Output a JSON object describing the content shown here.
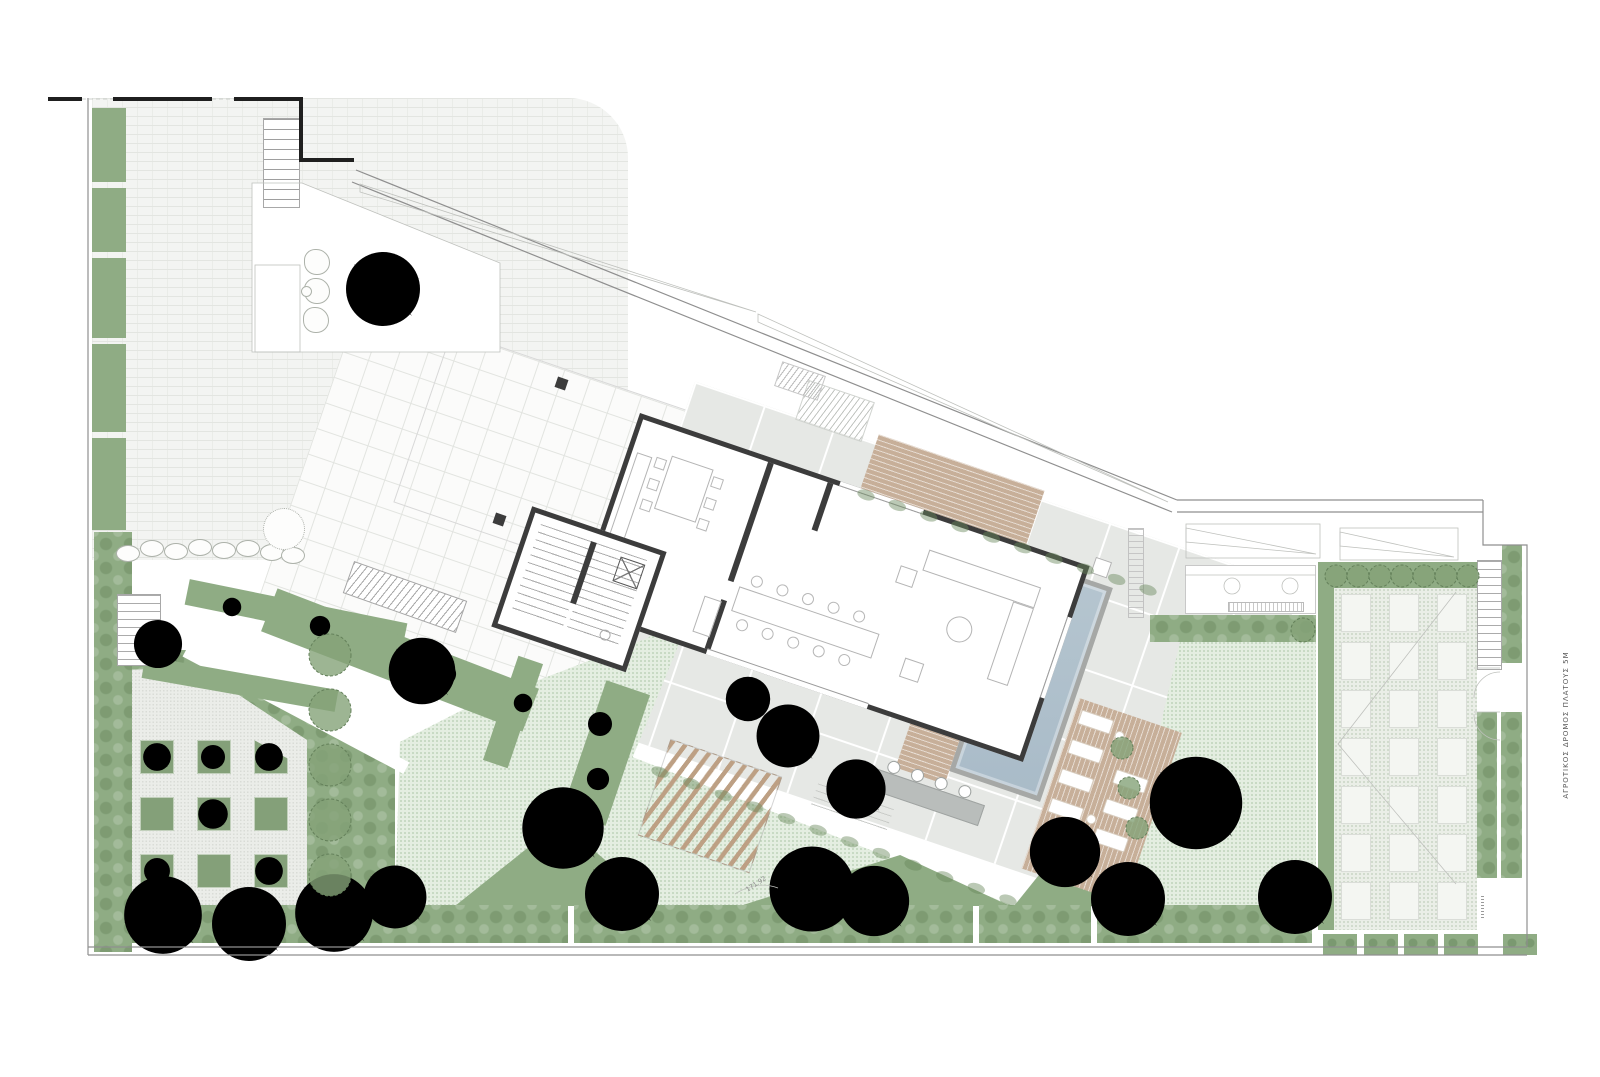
{
  "annotations": {
    "road_label": "ΑΓΡΟΤΙΚΟΣ ΔΡΟΜΟΣ ΠΛΑΤΟΥΣ 5Μ",
    "boundary_dimension": "171.92"
  },
  "palette": {
    "paper": "#FFFFFF",
    "sage": "#8FAC84",
    "sage-dark": "#7A9A6E",
    "lawn": "#E4EEE1",
    "pale": "#EBEDE9",
    "brick": "#F3F4F2",
    "tile": "#FBFBFA",
    "concrete": "#E6E8E5",
    "wall": "#3C3C3C",
    "wood": "#C7AF99",
    "water": "#AFC0CB",
    "tree-dark": "#4D534B",
    "tree-light": "#9BA296",
    "line": "#8F8F8F"
  },
  "site": {
    "left_strips": [
      [
        108,
        74
      ],
      [
        188,
        64
      ],
      [
        258,
        80
      ],
      [
        344,
        88
      ],
      [
        438,
        92
      ]
    ],
    "bottom_band": [
      {
        "x": 100,
        "w": 468
      },
      {
        "x": 574,
        "w": 399
      },
      {
        "x": 979,
        "w": 112
      },
      {
        "x": 1097,
        "w": 215
      }
    ],
    "green_boxes": [
      1322,
      1363,
      1403,
      1443,
      1502
    ],
    "planter_grid": {
      "x0": 140,
      "y0": 740,
      "step": 57,
      "size": 34,
      "rows": 3,
      "cols": 3,
      "clipped_cell": 2
    },
    "orchard_grid": {
      "cols": [
        1341,
        1389,
        1437
      ],
      "y0": 594,
      "step": 48,
      "w": 30,
      "h": 38,
      "rows": 7
    },
    "stones": [
      [
        128,
        554
      ],
      [
        152,
        549
      ],
      [
        176,
        552
      ],
      [
        200,
        548
      ],
      [
        224,
        551
      ],
      [
        248,
        549
      ],
      [
        272,
        553
      ],
      [
        293,
        556
      ]
    ],
    "boulders": [
      [
        317,
        262
      ],
      [
        317,
        291
      ],
      [
        316,
        320
      ]
    ],
    "loungers": [
      [
        106,
        125
      ],
      [
        106,
        156
      ],
      [
        106,
        187
      ],
      [
        106,
        218
      ],
      [
        158,
        170
      ],
      [
        158,
        201
      ],
      [
        158,
        232
      ]
    ],
    "lounger_tables": [
      [
        150,
        138
      ],
      [
        150,
        226
      ]
    ],
    "stools": [
      -60,
      -35,
      -10,
      15
    ],
    "trees": [
      {
        "x": 383,
        "y": 289,
        "r": 40,
        "kind": "dark"
      },
      {
        "x": 422,
        "y": 671,
        "r": 36,
        "kind": "dark"
      },
      {
        "x": 158,
        "y": 644,
        "r": 26,
        "kind": "dark"
      },
      {
        "x": 163,
        "y": 915,
        "r": 42,
        "kind": "dark"
      },
      {
        "x": 249,
        "y": 924,
        "r": 40,
        "kind": "dark"
      },
      {
        "x": 334,
        "y": 913,
        "r": 42,
        "kind": "dark"
      },
      {
        "x": 395,
        "y": 897,
        "r": 34,
        "kind": "dark"
      },
      {
        "x": 563,
        "y": 828,
        "r": 44,
        "kind": "dark"
      },
      {
        "x": 622,
        "y": 894,
        "r": 40,
        "kind": "dark"
      },
      {
        "x": 812,
        "y": 889,
        "r": 46,
        "kind": "dark"
      },
      {
        "x": 874,
        "y": 901,
        "r": 38,
        "kind": "dark"
      },
      {
        "x": 1065,
        "y": 852,
        "r": 38,
        "kind": "dark"
      },
      {
        "x": 1128,
        "y": 899,
        "r": 40,
        "kind": "dark"
      },
      {
        "x": 1196,
        "y": 803,
        "r": 50,
        "kind": "dark"
      },
      {
        "x": 1295,
        "y": 897,
        "r": 40,
        "kind": "dark"
      },
      {
        "x": 788,
        "y": 736,
        "r": 34,
        "kind": "light"
      },
      {
        "x": 856,
        "y": 789,
        "r": 32,
        "kind": "light"
      },
      {
        "x": 748,
        "y": 699,
        "r": 24,
        "kind": "light"
      },
      {
        "x": 157,
        "y": 757,
        "r": 15,
        "kind": "sage"
      },
      {
        "x": 269,
        "y": 757,
        "r": 15,
        "kind": "sage"
      },
      {
        "x": 213,
        "y": 814,
        "r": 16,
        "kind": "sage"
      },
      {
        "x": 157,
        "y": 871,
        "r": 14,
        "kind": "sage"
      },
      {
        "x": 269,
        "y": 871,
        "r": 15,
        "kind": "sage"
      },
      {
        "x": 213,
        "y": 757,
        "r": 13,
        "kind": "sage"
      },
      {
        "x": 232,
        "y": 607,
        "r": 10,
        "kind": "light"
      },
      {
        "x": 320,
        "y": 626,
        "r": 11,
        "kind": "light"
      },
      {
        "x": 445,
        "y": 674,
        "r": 12,
        "kind": "light"
      },
      {
        "x": 600,
        "y": 724,
        "r": 13,
        "kind": "sage"
      },
      {
        "x": 598,
        "y": 779,
        "r": 12,
        "kind": "sage"
      },
      {
        "x": 523,
        "y": 703,
        "r": 10,
        "kind": "light"
      }
    ],
    "round_trees": [
      {
        "x": 330,
        "y": 655,
        "r": 21
      },
      {
        "x": 330,
        "y": 710,
        "r": 21
      },
      {
        "x": 330,
        "y": 765,
        "r": 21
      },
      {
        "x": 330,
        "y": 820,
        "r": 21
      },
      {
        "x": 330,
        "y": 875,
        "r": 21
      },
      {
        "x": 1336,
        "y": 576,
        "r": 11
      },
      {
        "x": 1358,
        "y": 576,
        "r": 11
      },
      {
        "x": 1380,
        "y": 576,
        "r": 11
      },
      {
        "x": 1402,
        "y": 576,
        "r": 11
      },
      {
        "x": 1424,
        "y": 576,
        "r": 11
      },
      {
        "x": 1446,
        "y": 576,
        "r": 11
      },
      {
        "x": 1468,
        "y": 576,
        "r": 11
      },
      {
        "x": 1303,
        "y": 630,
        "r": 12
      },
      {
        "x": 1122,
        "y": 748,
        "r": 11
      },
      {
        "x": 1129,
        "y": 788,
        "r": 11
      },
      {
        "x": 1137,
        "y": 828,
        "r": 11
      }
    ],
    "shrub_rows": [
      {
        "from": [
          660,
          772
        ],
        "to": [
          1008,
          900
        ],
        "n": 12
      },
      {
        "from": [
          866,
          495
        ],
        "to": [
          1148,
          590
        ],
        "n": 10
      }
    ]
  },
  "building": {
    "furniture_rects": [
      {
        "x": 10,
        "y": 38,
        "w": 16,
        "h": 88
      },
      {
        "x": 44,
        "y": 30,
        "w": 44,
        "h": 56
      },
      {
        "x": 150,
        "y": 132,
        "w": 148,
        "h": 26
      },
      {
        "x": 318,
        "y": 36,
        "w": 118,
        "h": 22
      },
      {
        "x": 414,
        "y": 58,
        "w": 22,
        "h": 82
      },
      {
        "x": 330,
        "y": 146,
        "w": 20,
        "h": 20
      },
      {
        "x": 296,
        "y": 60,
        "w": 18,
        "h": 18
      },
      {
        "x": 120,
        "y": 152,
        "w": 18,
        "h": 38
      }
    ],
    "furniture_circles": [
      {
        "x": 372,
        "y": 102,
        "r": 13
      }
    ],
    "dining_chairs": {
      "xs": [
        165,
        192,
        219,
        246,
        273
      ],
      "ys": [
        122,
        168
      ],
      "r": 6
    },
    "kitchen_chairs": [
      [
        30,
        36
      ],
      [
        30,
        58
      ],
      [
        30,
        80
      ],
      [
        90,
        36
      ],
      [
        90,
        58
      ],
      [
        90,
        80
      ]
    ]
  }
}
